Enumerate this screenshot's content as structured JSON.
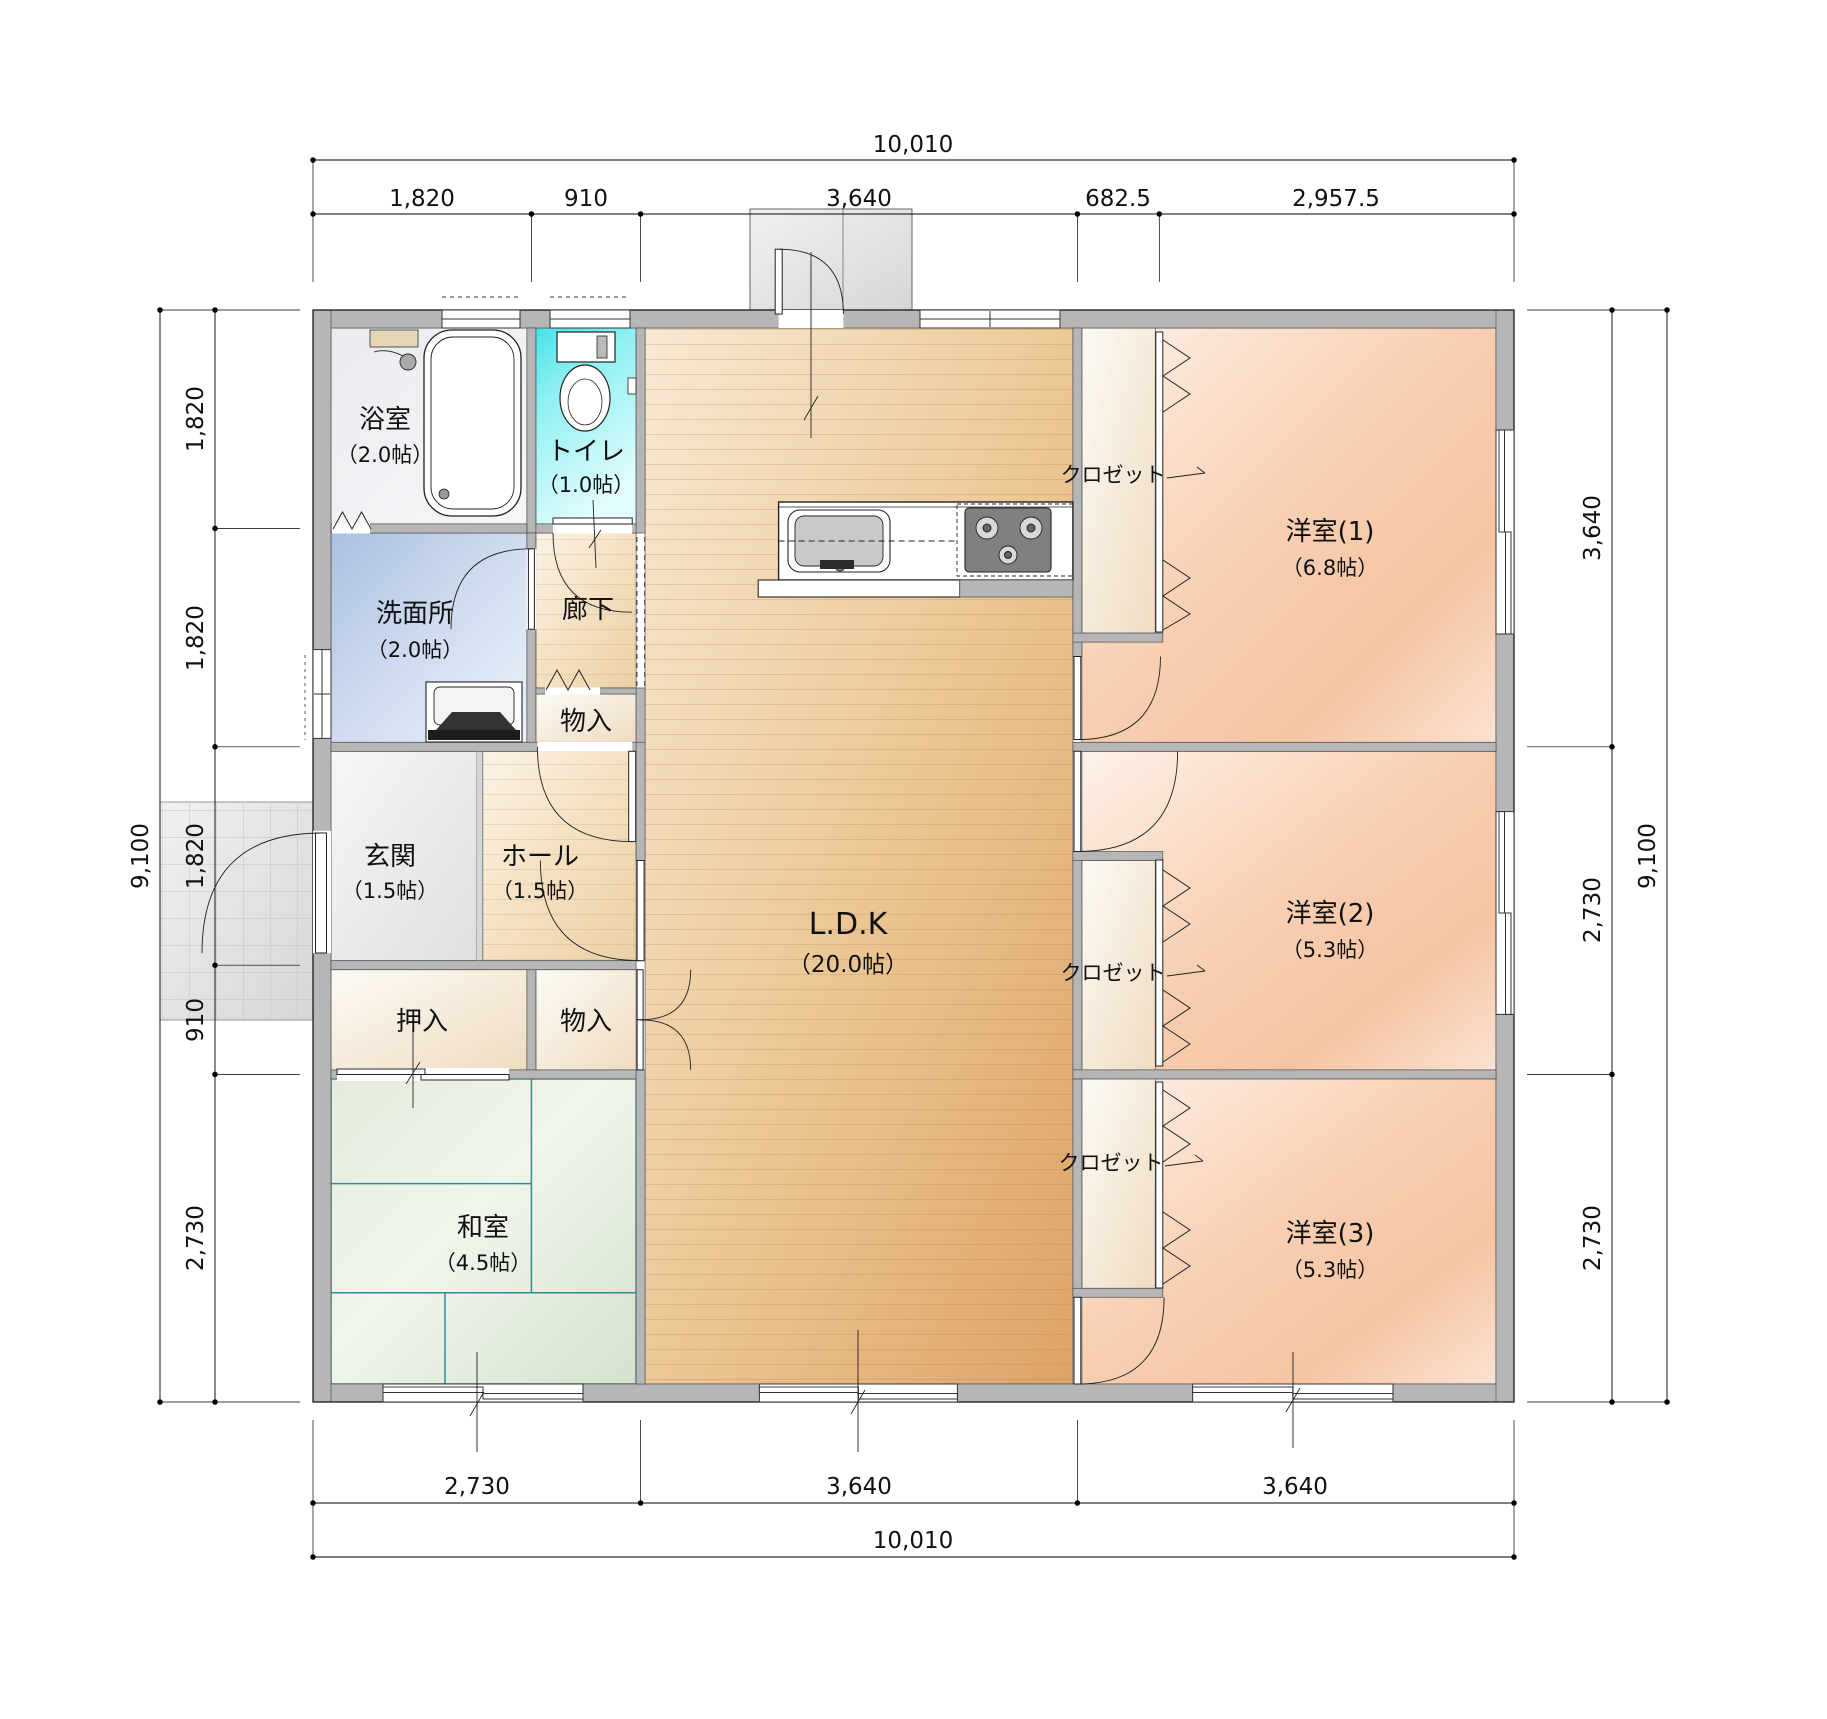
{
  "plan": {
    "dim_top": {
      "total": "10,010",
      "segments": [
        "1,820",
        "910",
        "3,640",
        "682.5",
        "2,957.5"
      ]
    },
    "dim_bottom": {
      "total": "10,010",
      "segments": [
        "2,730",
        "3,640",
        "3,640"
      ]
    },
    "dim_left": {
      "total": "9,100",
      "segments": [
        "1,820",
        "1,820",
        "1,820",
        "910",
        "2,730"
      ]
    },
    "dim_right": {
      "total": "9,100",
      "segments": [
        "3,640",
        "2,730",
        "2,730"
      ]
    },
    "rooms": {
      "bath": {
        "name": "浴室",
        "size": "（2.0帖）"
      },
      "toilet": {
        "name": "トイレ",
        "size": "（1.0帖）"
      },
      "washroom": {
        "name": "洗面所",
        "size": "（2.0帖）"
      },
      "corridor": {
        "name": "廊下"
      },
      "storage_corridor": {
        "name": "物入"
      },
      "entrance": {
        "name": "玄関",
        "size": "（1.5帖）"
      },
      "hall": {
        "name": "ホール",
        "size": "（1.5帖）"
      },
      "oshiire": {
        "name": "押入"
      },
      "storage_hall": {
        "name": "物入"
      },
      "japanese_room": {
        "name": "和室",
        "size": "（4.5帖）"
      },
      "ldk": {
        "name": "L.D.K",
        "size": "（20.0帖）"
      },
      "western1": {
        "name": "洋室(1)",
        "size": "（6.8帖）"
      },
      "western2": {
        "name": "洋室(2)",
        "size": "（5.3帖）"
      },
      "western3": {
        "name": "洋室(3)",
        "size": "（5.3帖）"
      },
      "closet1": {
        "name": "クロゼット"
      },
      "closet2": {
        "name": "クロゼット"
      },
      "closet3": {
        "name": "クロゼット"
      }
    },
    "colors": {
      "wall": "#b6b6b6",
      "tatami_line": "#2f8f8f",
      "toilet_accent": "#45e4e8",
      "washroom_accent": "#aabfe0",
      "ldk_floor": "#ecc897",
      "western_floor": "#f8d0b4"
    }
  }
}
